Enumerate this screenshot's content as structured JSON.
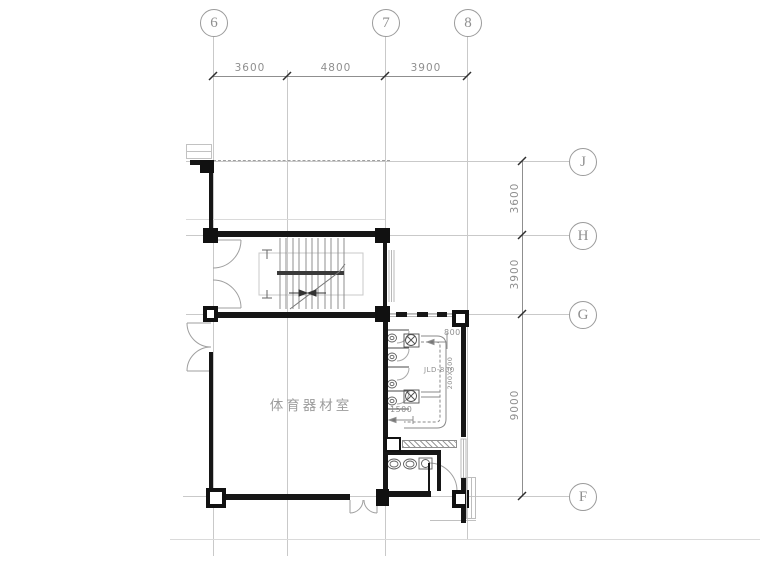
{
  "drawing_title": "floor-plan",
  "grid": {
    "top_axes": [
      {
        "label": "6"
      },
      {
        "label": "7"
      },
      {
        "label": "8"
      }
    ],
    "side_axes": [
      {
        "label": "J"
      },
      {
        "label": "H"
      },
      {
        "label": "G"
      },
      {
        "label": "F"
      }
    ],
    "top_dims": [
      "3600",
      "4800",
      "3900"
    ],
    "side_dims": [
      "3600",
      "3900",
      "9000"
    ]
  },
  "plan": {
    "room_label": "体育器材室",
    "annotations": {
      "duct_width": "800",
      "floor_drain": "JLD-800",
      "shaft_size": "200X200",
      "stall_depth": "1500"
    }
  },
  "colors": {
    "wall": "#161616",
    "grid_line": "#c9c9c9",
    "dim_text": "#8f8f8f",
    "fixture_line": "#5f5f5f",
    "background": "#ffffff"
  }
}
